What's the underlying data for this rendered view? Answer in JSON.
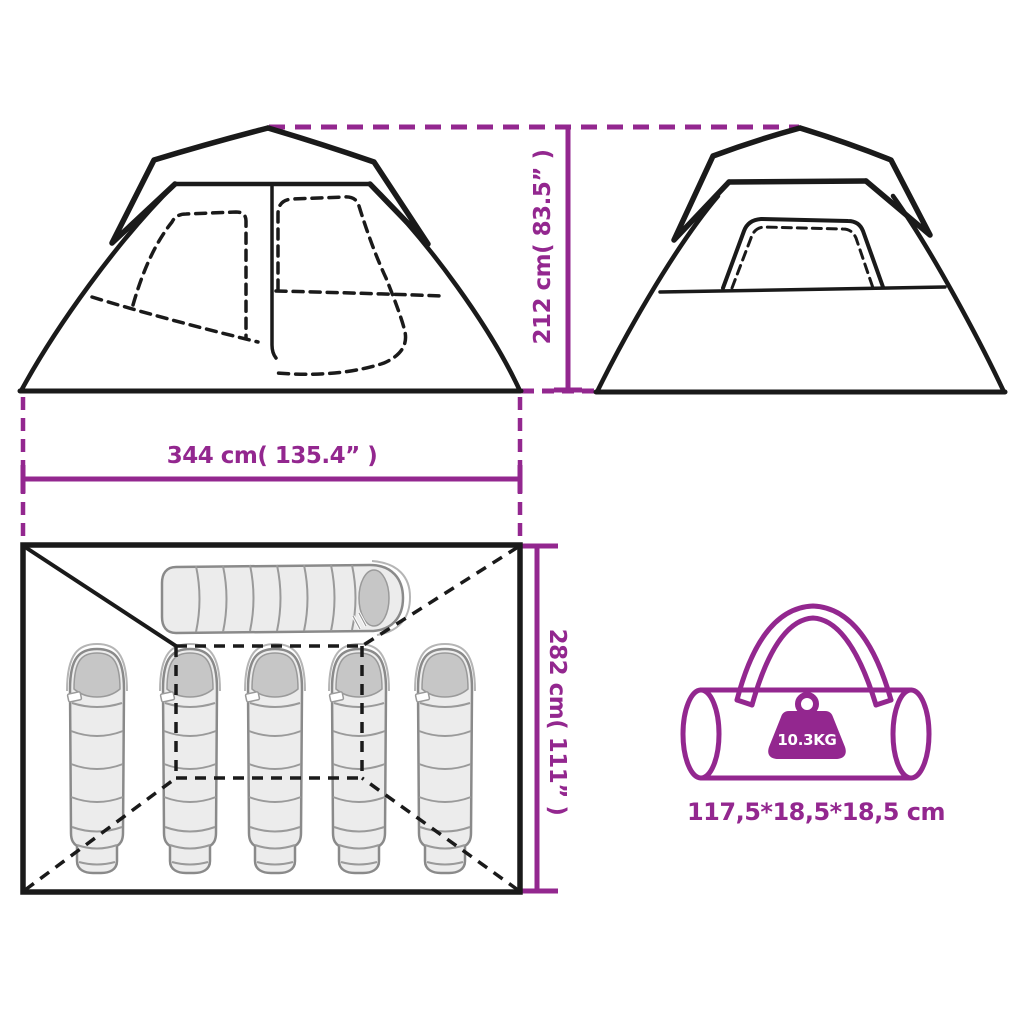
{
  "labels": {
    "height": "212 cm( 83.5”  )",
    "width": "344 cm( 135.4”  )",
    "depth": "282 cm( 111”  )",
    "weight": "10.3KG",
    "packed_size": "117,5*18,5*18,5 cm"
  },
  "colors": {
    "accent": "#93278F",
    "line": "#1a1a1a",
    "bag_fill": "#ececec",
    "bag_shade": "#c6c6c6",
    "bag_outline": "#8a8a8a",
    "background": "#ffffff"
  },
  "figures": {
    "front_view_icon": "tent-front-view-icon",
    "side_view_icon": "tent-side-view-icon",
    "floor_plan_icon": "tent-floor-plan-icon",
    "carry_bag_icon": "carry-bag-icon",
    "weight_icon": "weight-icon",
    "sleeping_bags_upright": 5,
    "sleeping_bags_horizontal": 1
  }
}
